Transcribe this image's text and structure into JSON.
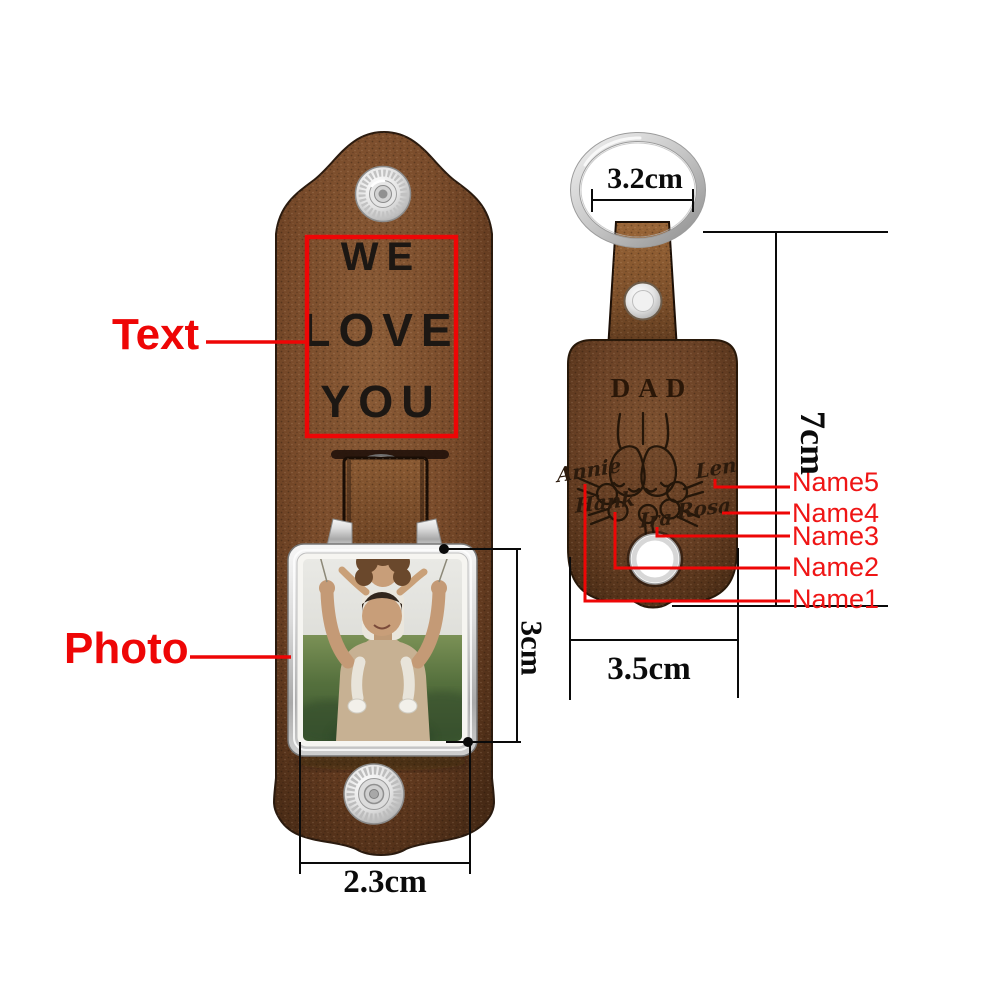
{
  "page": {
    "background": "#ffffff"
  },
  "palette": {
    "annotation_red": "#ee0606",
    "label_red": "#ef1515",
    "dimension_black": "#0b0b0b",
    "leather_left": "#75492a",
    "leather_right": "#6b4429",
    "metal_silver": "#d9d9d9",
    "engraving_dark": "#241609"
  },
  "left_keychain": {
    "engraving_lines": [
      "WE",
      "LOVE",
      "YOU"
    ]
  },
  "right_keychain": {
    "title": "DAD",
    "engraved_names": [
      "Annie",
      "Hank",
      "Ira",
      "Rosa",
      "Len"
    ]
  },
  "annotations": {
    "callout_text": "Text",
    "callout_photo": "Photo",
    "name_labels": [
      "Name5",
      "Name4",
      "Name3",
      "Name2",
      "Name1"
    ],
    "dimensions": {
      "ring_width": "3.2cm",
      "tag_height": "7cm",
      "tag_width": "3.5cm",
      "photo_height": "3cm",
      "strap_width": "2.3cm"
    }
  }
}
